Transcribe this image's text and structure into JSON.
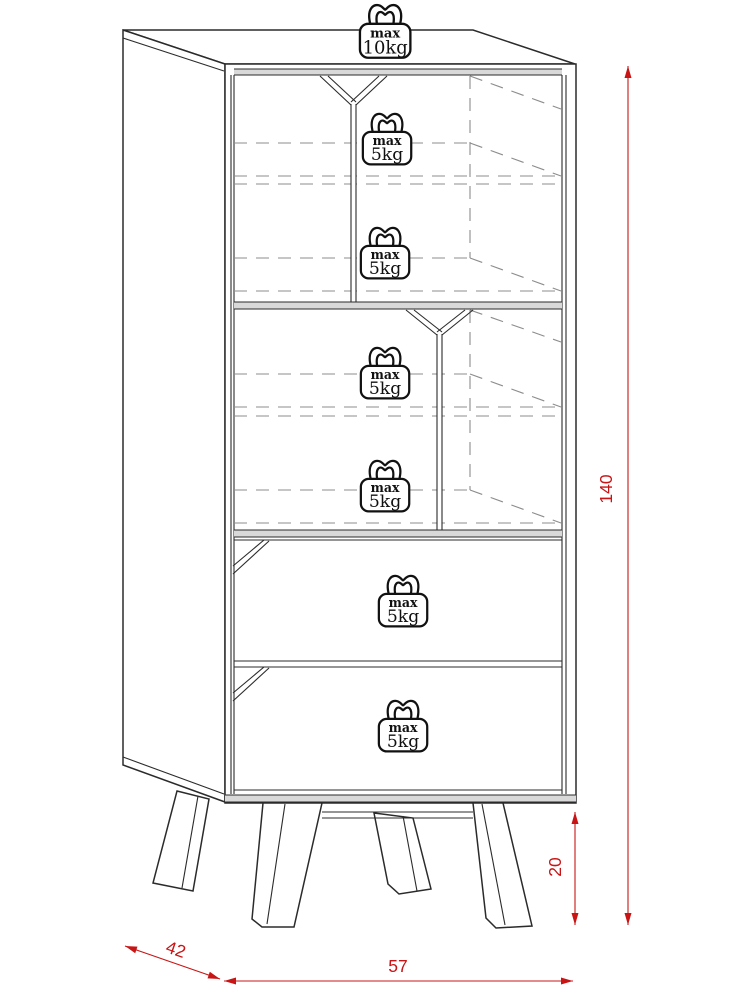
{
  "diagram": {
    "kind": "cabinet-dimension-drawing"
  },
  "weights": [
    {
      "id": "top-panel",
      "line1": "max",
      "line2": "10kg"
    },
    {
      "id": "section1-shelf-a",
      "line1": "max",
      "line2": "5kg"
    },
    {
      "id": "section1-shelf-b",
      "line1": "max",
      "line2": "5kg"
    },
    {
      "id": "section2-shelf-a",
      "line1": "max",
      "line2": "5kg"
    },
    {
      "id": "section2-shelf-b",
      "line1": "max",
      "line2": "5kg"
    },
    {
      "id": "drawer-1",
      "line1": "max",
      "line2": "5kg"
    },
    {
      "id": "drawer-2",
      "line1": "max",
      "line2": "5kg"
    }
  ],
  "dimensions": {
    "total_height": {
      "value": "140"
    },
    "leg_height": {
      "value": "20"
    },
    "depth": {
      "value": "42"
    },
    "width": {
      "value": "57"
    }
  },
  "colors": {
    "dimension_red": "#c81414",
    "outline": "#2b2b2b",
    "hidden_line": "#8c8c8c",
    "panel_shade": "#d9d9d9",
    "background": "#ffffff"
  }
}
